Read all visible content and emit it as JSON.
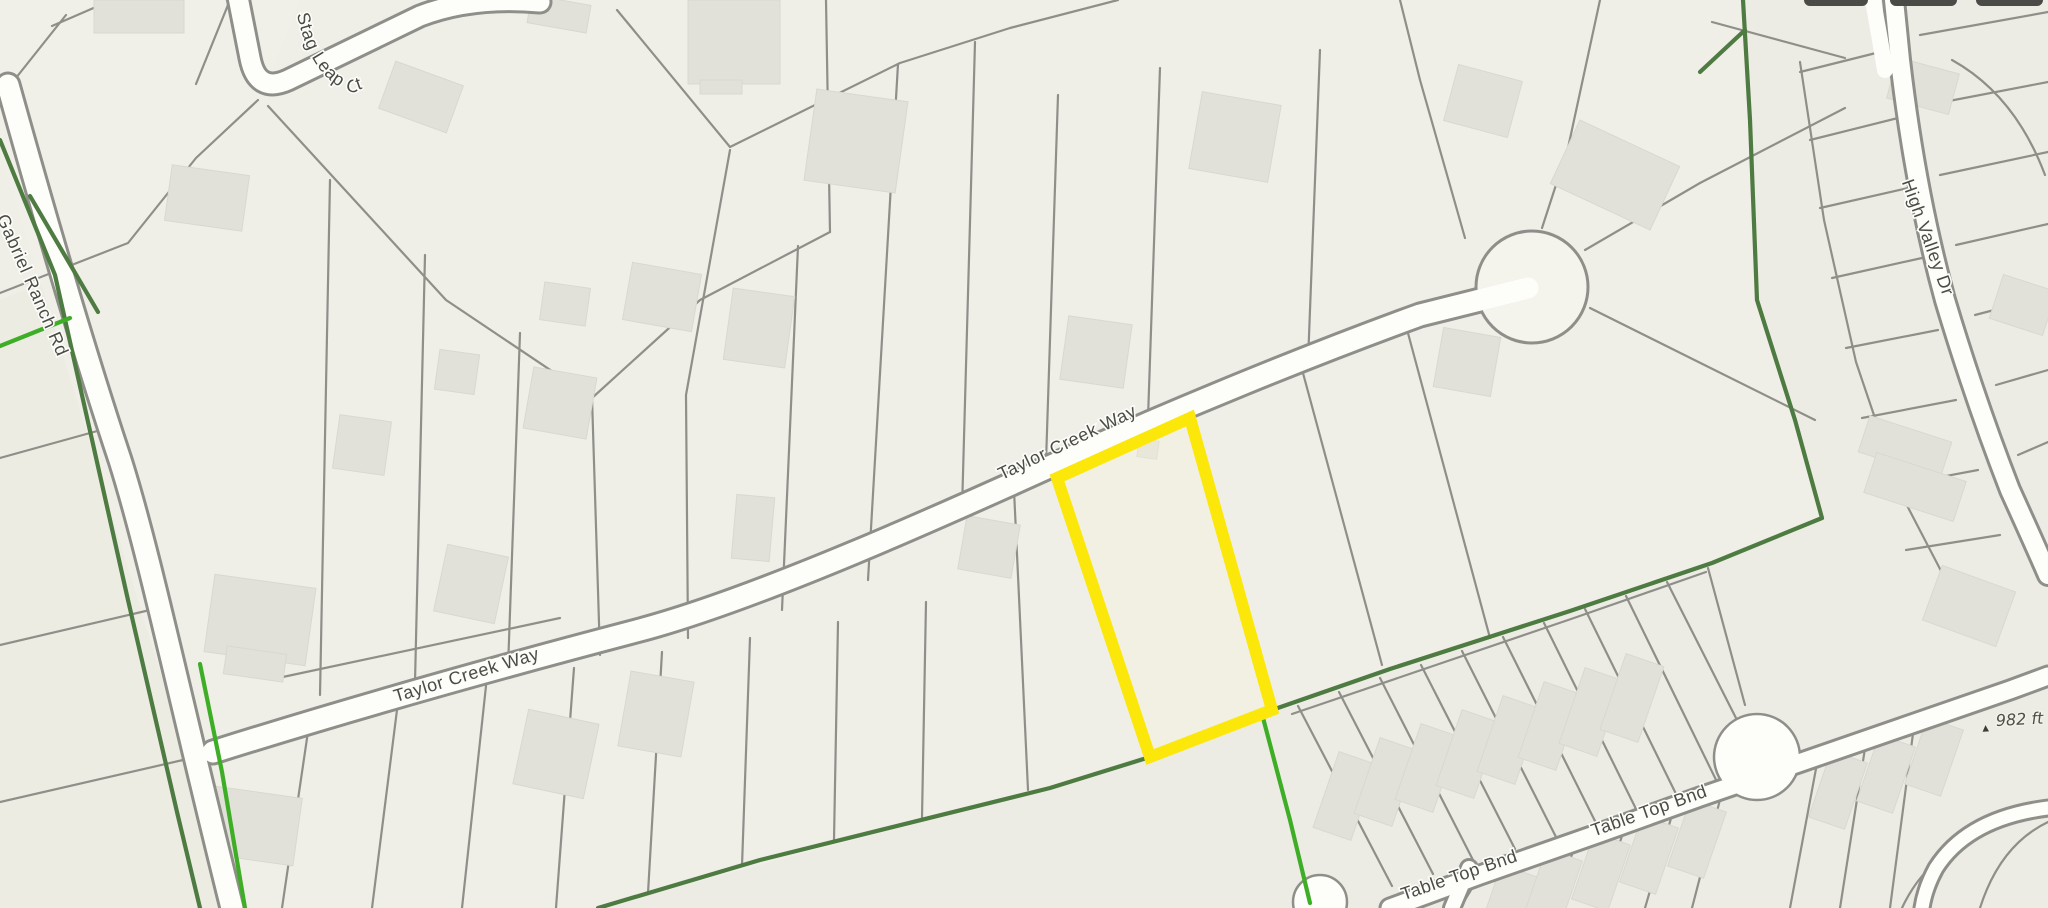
{
  "map": {
    "street_labels": {
      "stag_leap": "Stag Leap Ct",
      "gabriel_ranch": "Gabriel Ranch Rd",
      "taylor_creek_lower": "Taylor Creek Way",
      "taylor_creek_upper": "Taylor Creek Way",
      "high_valley": "High Valley Dr",
      "table_top_left": "Table Top Bnd",
      "table_top_right": "Table Top Bnd"
    },
    "elevation_marker": {
      "label": "982 ft",
      "symbol": "▲"
    },
    "selected_parcel": {
      "outline_color": "#fce70a"
    },
    "colors": {
      "background": "#efeee7",
      "parcel_line": "#8f8f8a",
      "building": "#e2e1d9",
      "road_fill": "#fdfdfa",
      "road_casing": "#8f8f8a",
      "boundary_dark_green": "#4e7b41",
      "boundary_bright_green": "#3fae27",
      "label_text": "#4b4b46",
      "top_tabs": "#4a4a46"
    }
  }
}
